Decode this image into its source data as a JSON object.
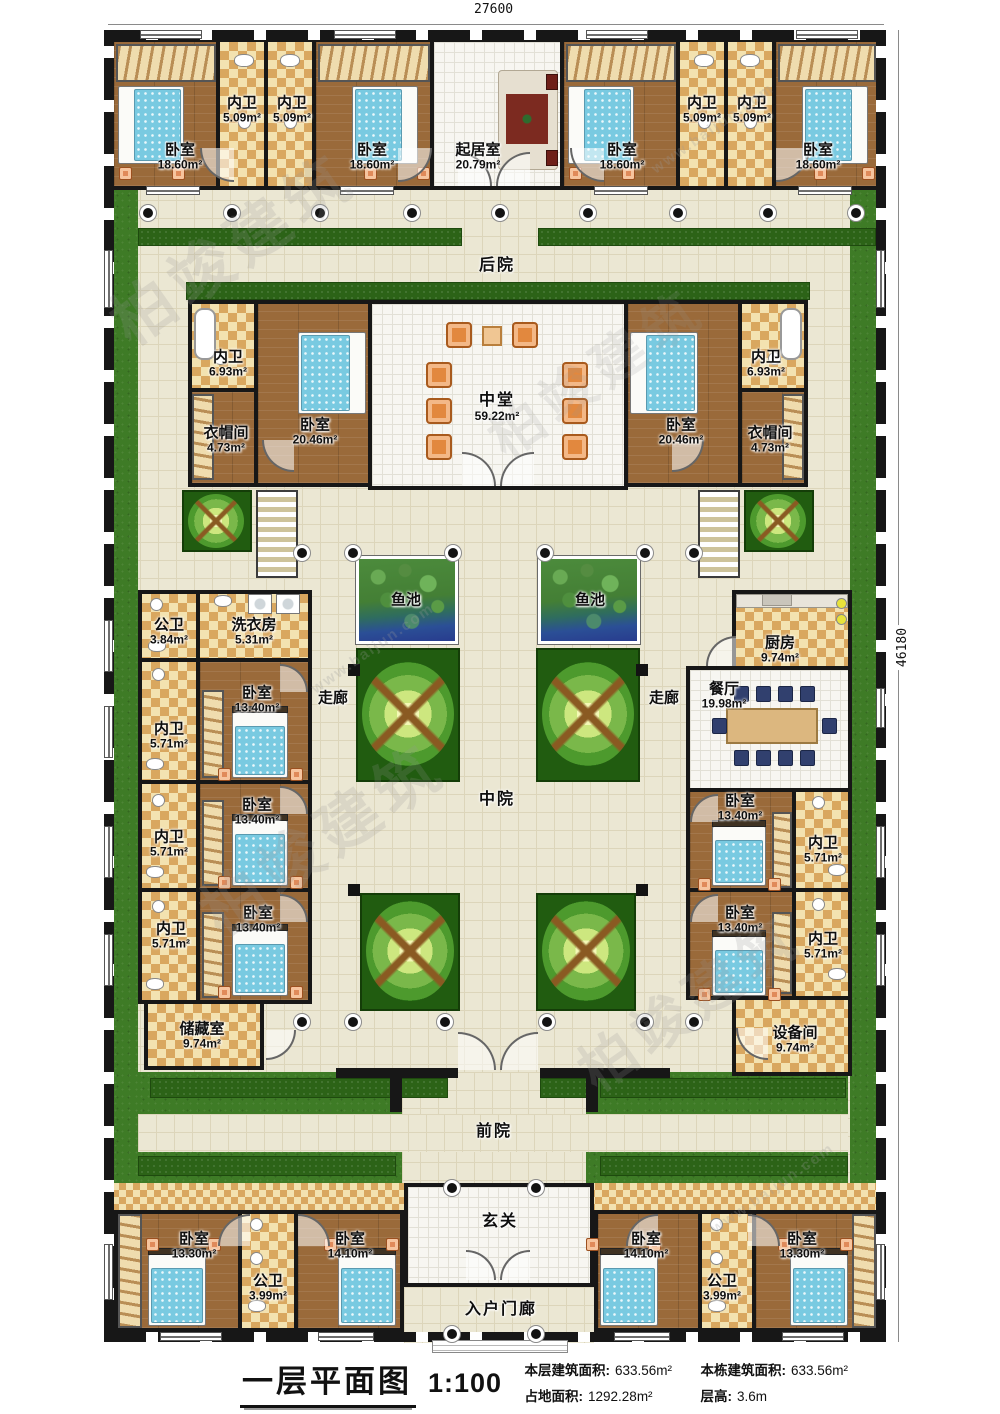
{
  "dims": {
    "top": "27600",
    "right": "46180"
  },
  "watermark": {
    "cn": "柏竣建筑",
    "en": "www.baijun.com"
  },
  "areas": {
    "backyard": "后院",
    "midyard": "中院",
    "frontyard": "前院",
    "corridor_left": "走廊",
    "corridor_right": "走廊",
    "pond_left": "鱼池",
    "pond_right": "鱼池",
    "foyer": "玄关",
    "porch": "入户门廊"
  },
  "rooms": {
    "top_bed1": {
      "label": "卧室",
      "area": "18.60m²"
    },
    "top_wc1": {
      "label": "内卫",
      "area": "5.09m²"
    },
    "top_wc2": {
      "label": "内卫",
      "area": "5.09m²"
    },
    "top_bed2": {
      "label": "卧室",
      "area": "18.60m²"
    },
    "living": {
      "label": "起居室",
      "area": "20.79m²"
    },
    "top_bed3": {
      "label": "卧室",
      "area": "18.60m²"
    },
    "top_wc3": {
      "label": "内卫",
      "area": "5.09m²"
    },
    "top_wc4": {
      "label": "内卫",
      "area": "5.09m²"
    },
    "top_bed4": {
      "label": "卧室",
      "area": "18.60m²"
    },
    "mid_wc_left": {
      "label": "内卫",
      "area": "6.93m²"
    },
    "cloak_left": {
      "label": "衣帽间",
      "area": "4.73m²"
    },
    "mid_bed_left": {
      "label": "卧室",
      "area": "20.46m²"
    },
    "hall": {
      "label": "中堂",
      "area": "59.22m²"
    },
    "mid_bed_right": {
      "label": "卧室",
      "area": "20.46m²"
    },
    "mid_wc_right": {
      "label": "内卫",
      "area": "6.93m²"
    },
    "cloak_right": {
      "label": "衣帽间",
      "area": "4.73m²"
    },
    "pub_wc_left": {
      "label": "公卫",
      "area": "3.84m²"
    },
    "laundry": {
      "label": "洗衣房",
      "area": "5.31m²"
    },
    "lw_bed1": {
      "label": "卧室",
      "area": "13.40m²"
    },
    "lw_wc1": {
      "label": "内卫",
      "area": "5.71m²"
    },
    "lw_bed2": {
      "label": "卧室",
      "area": "13.40m²"
    },
    "lw_wc2": {
      "label": "内卫",
      "area": "5.71m²"
    },
    "lw_bed3": {
      "label": "卧室",
      "area": "13.40m²"
    },
    "lw_wc3": {
      "label": "内卫",
      "area": "5.71m²"
    },
    "storage": {
      "label": "储藏室",
      "area": "9.74m²"
    },
    "kitchen": {
      "label": "厨房",
      "area": "9.74m²"
    },
    "dining": {
      "label": "餐厅",
      "area": "19.98m²"
    },
    "rw_bed1": {
      "label": "卧室",
      "area": "13.40m²"
    },
    "rw_wc1": {
      "label": "内卫",
      "area": "5.71m²"
    },
    "rw_bed2": {
      "label": "卧室",
      "area": "13.40m²"
    },
    "rw_wc2": {
      "label": "内卫",
      "area": "5.71m²"
    },
    "equipment": {
      "label": "设备间",
      "area": "9.74m²"
    },
    "bl_bed1": {
      "label": "卧室",
      "area": "13.30m²"
    },
    "bl_wc": {
      "label": "公卫",
      "area": "3.99m²"
    },
    "bl_bed2": {
      "label": "卧室",
      "area": "14.10m²"
    },
    "br_bed1": {
      "label": "卧室",
      "area": "14.10m²"
    },
    "br_wc": {
      "label": "公卫",
      "area": "3.99m²"
    },
    "br_bed2": {
      "label": "卧室",
      "area": "13.30m²"
    }
  },
  "caption": {
    "title": "一层平面图",
    "scale": "1:100",
    "stats": [
      {
        "label": "本层建筑面积:",
        "value": "633.56m²"
      },
      {
        "label": "本栋建筑面积:",
        "value": "633.56m²"
      },
      {
        "label": "占地面积:",
        "value": "1292.28m²"
      },
      {
        "label": "层高:",
        "value": "3.6m"
      }
    ]
  }
}
